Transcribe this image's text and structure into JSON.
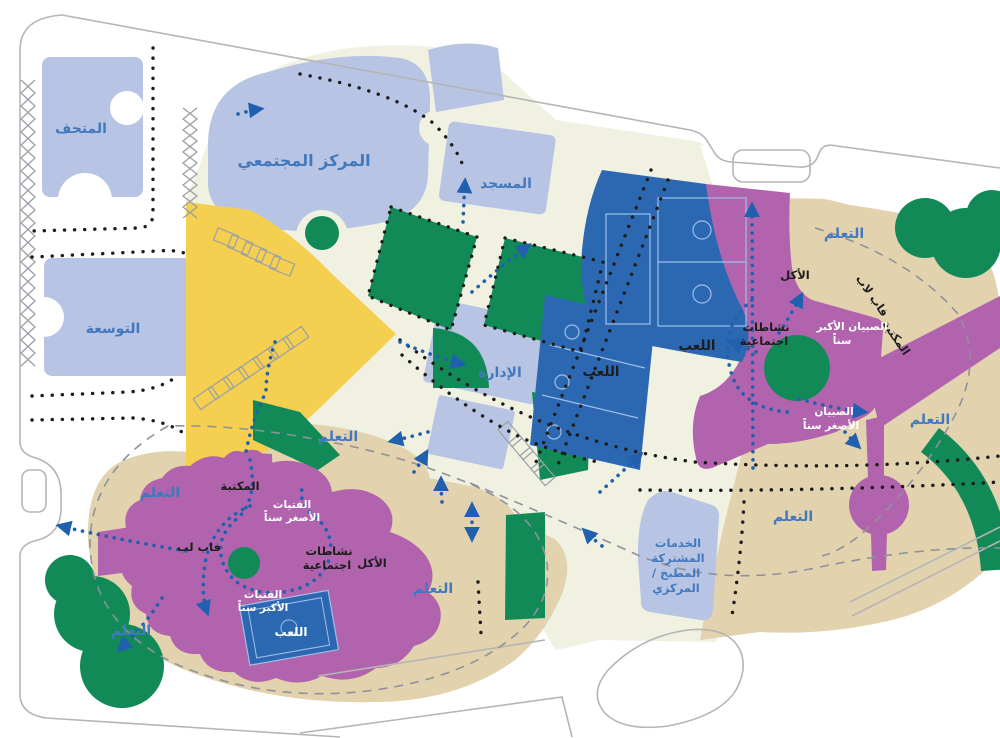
{
  "title": "site-plan-diagram",
  "labels": {
    "museum": "المتحف",
    "community_center": "المركز المجتمعي",
    "expansion": "التوسعة",
    "mosque": "المسجد",
    "admin": "الإدارة",
    "play": "اللعب",
    "learning": "التعلم",
    "library": "المكتبة",
    "fablab": "فاب لاب",
    "fablab_short": "فاب لب",
    "social_1": "نشاطات",
    "social_2": "اجتماعية",
    "eating": "الأكل",
    "girls_younger_1": "الفتيات",
    "girls_younger_2": "الأصغر سناً",
    "girls_older_1": "الفتيات",
    "girls_older_2": "الأكبر سناً",
    "boys_older_1": "الصبيان الأكبر",
    "boys_older_2": "سناً",
    "boys_younger_1": "الصبيان",
    "boys_younger_2": "الأصغر سناً",
    "shared_1": "الخدمات",
    "shared_2": "المشتركة",
    "shared_3": "/ المطبخ",
    "shared_4": "المركزي"
  },
  "colors": {
    "periwinkle": "#b8c4e3",
    "cream": "#f0f1e1",
    "yellow": "#f5cf4f",
    "green": "#118a57",
    "blue": "#2c68b2",
    "court_line": "#9fbfe6",
    "purple": "#b164ad",
    "tan": "#e3d2ae",
    "label_blue": "#4279be",
    "label_black": "#1d1d1d",
    "label_white": "#ffffff",
    "arrow_blue": "#2160ae",
    "dash_gray": "#8d929c",
    "road_gray": "#b5b5b5"
  }
}
